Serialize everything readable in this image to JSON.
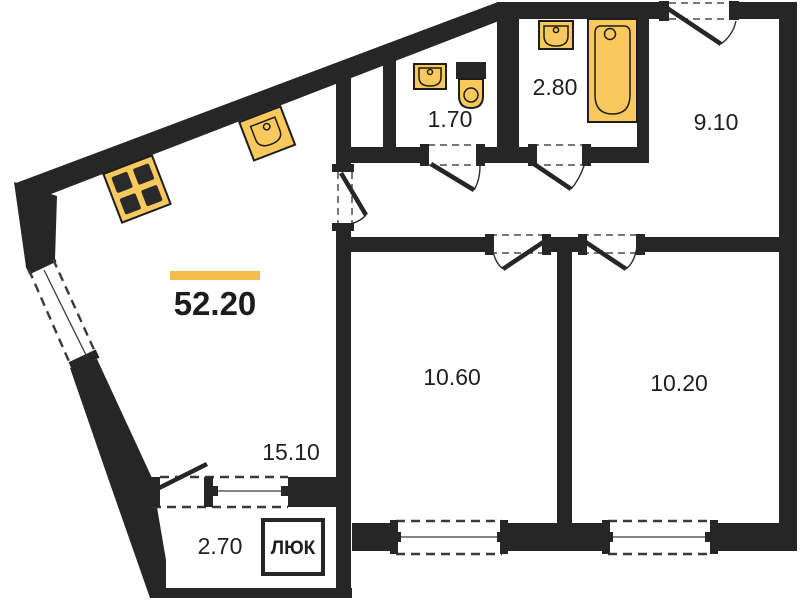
{
  "floorplan": {
    "total_area": "52.20",
    "rooms": [
      {
        "id": "kitchen-living",
        "area": "15.10"
      },
      {
        "id": "bedroom-1",
        "area": "10.60"
      },
      {
        "id": "bedroom-2",
        "area": "10.20"
      },
      {
        "id": "hallway",
        "area": "9.10"
      },
      {
        "id": "bathroom",
        "area": "2.80"
      },
      {
        "id": "wc",
        "area": "1.70"
      },
      {
        "id": "balcony",
        "area": "2.70"
      }
    ],
    "hatch_label": "ЛЮК",
    "fixtures": [
      "stove-icon",
      "kitchen-sink-icon",
      "wc-sink-icon",
      "toilet-icon",
      "bath-sink-icon",
      "bathtub-icon"
    ],
    "colors": {
      "wall": "#262626",
      "fixture_fill": "#F9C95D",
      "fixture_stroke": "#1D1D1D",
      "accent_bar": "#F3BC4D",
      "text": "#1F1F1F",
      "background": "#FFFFFF"
    }
  }
}
